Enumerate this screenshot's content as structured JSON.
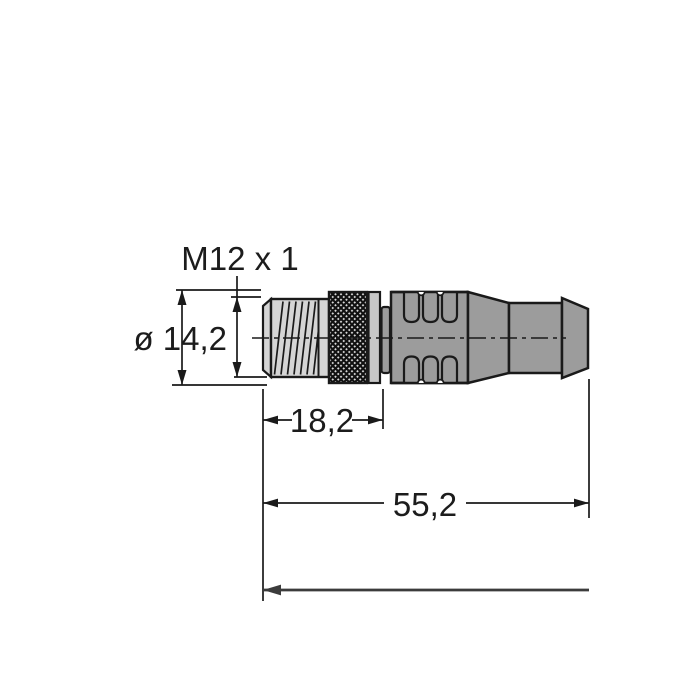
{
  "drawing_labels": {
    "thread_spec": "M12 x 1",
    "diameter": "ø 14,2",
    "thread_length": "18,2",
    "overall_length": "55,2"
  },
  "colors": {
    "outline": "#1a1a1a",
    "body_gray": "#9c9c9c",
    "thread_gray": "#d5d5d5",
    "ring_gray": "#c7c7c7",
    "knurl_base": "#d8d8d8",
    "cable_line": "#3c3c3c",
    "background": "#ffffff"
  }
}
